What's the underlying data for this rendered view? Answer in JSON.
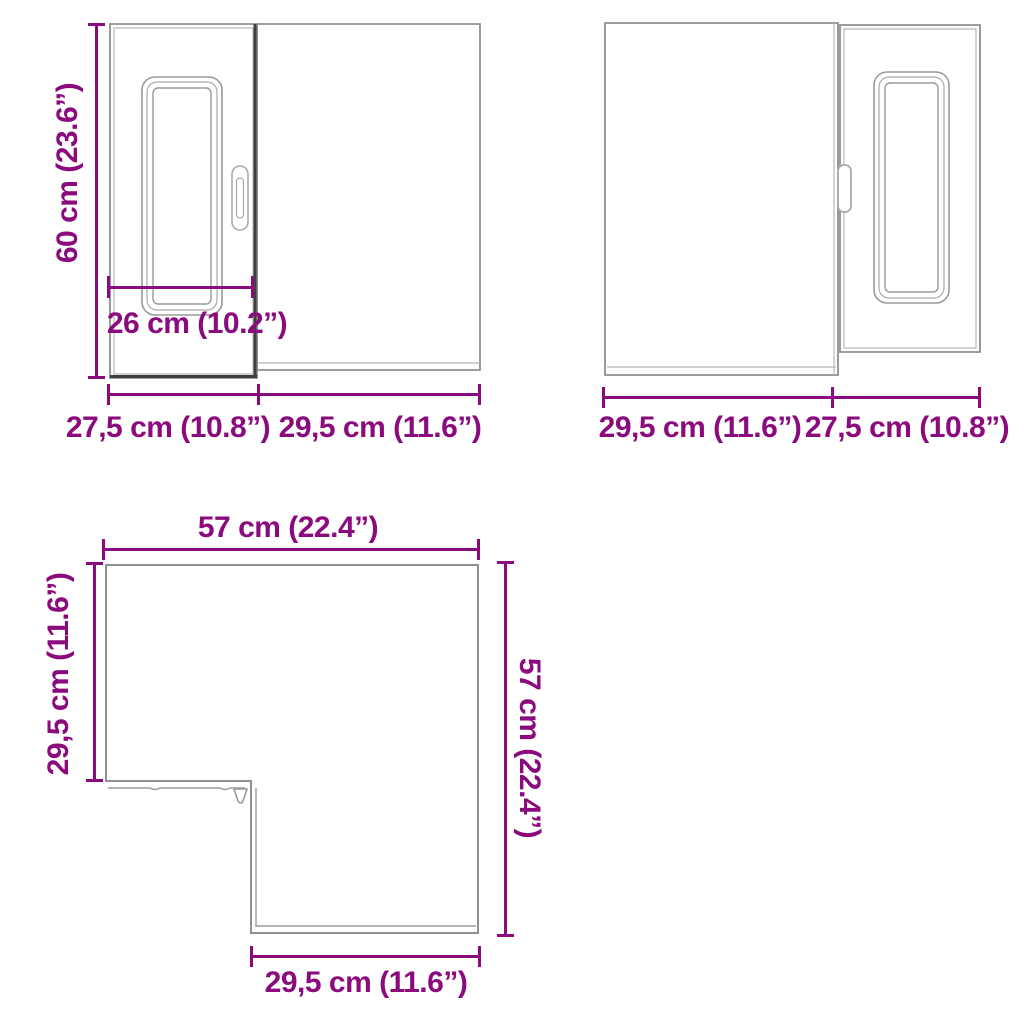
{
  "palette": {
    "dimension_color": "#8B0B7E",
    "outline_color": "#909090",
    "outline_light": "#B8B8B8",
    "outline_dark": "#3F3F3F",
    "background": "#FFFFFF"
  },
  "views": {
    "front": {
      "height_label": "60 cm (23.6”)",
      "door_width_label": "26 cm (10.2”)",
      "left_width_label": "27,5 cm (10.8”)",
      "right_width_label": "29,5 cm (11.6”)"
    },
    "front_mirrored": {
      "left_width_label": "29,5 cm (11.6”)",
      "right_width_label": "27,5 cm (10.8”)"
    },
    "top": {
      "top_width_label": "57 cm (22.4”)",
      "left_depth_label": "29,5 cm (11.6”)",
      "right_depth_label": "57 cm (22.4”)",
      "bottom_width_label": "29,5 cm (11.6”)"
    }
  }
}
